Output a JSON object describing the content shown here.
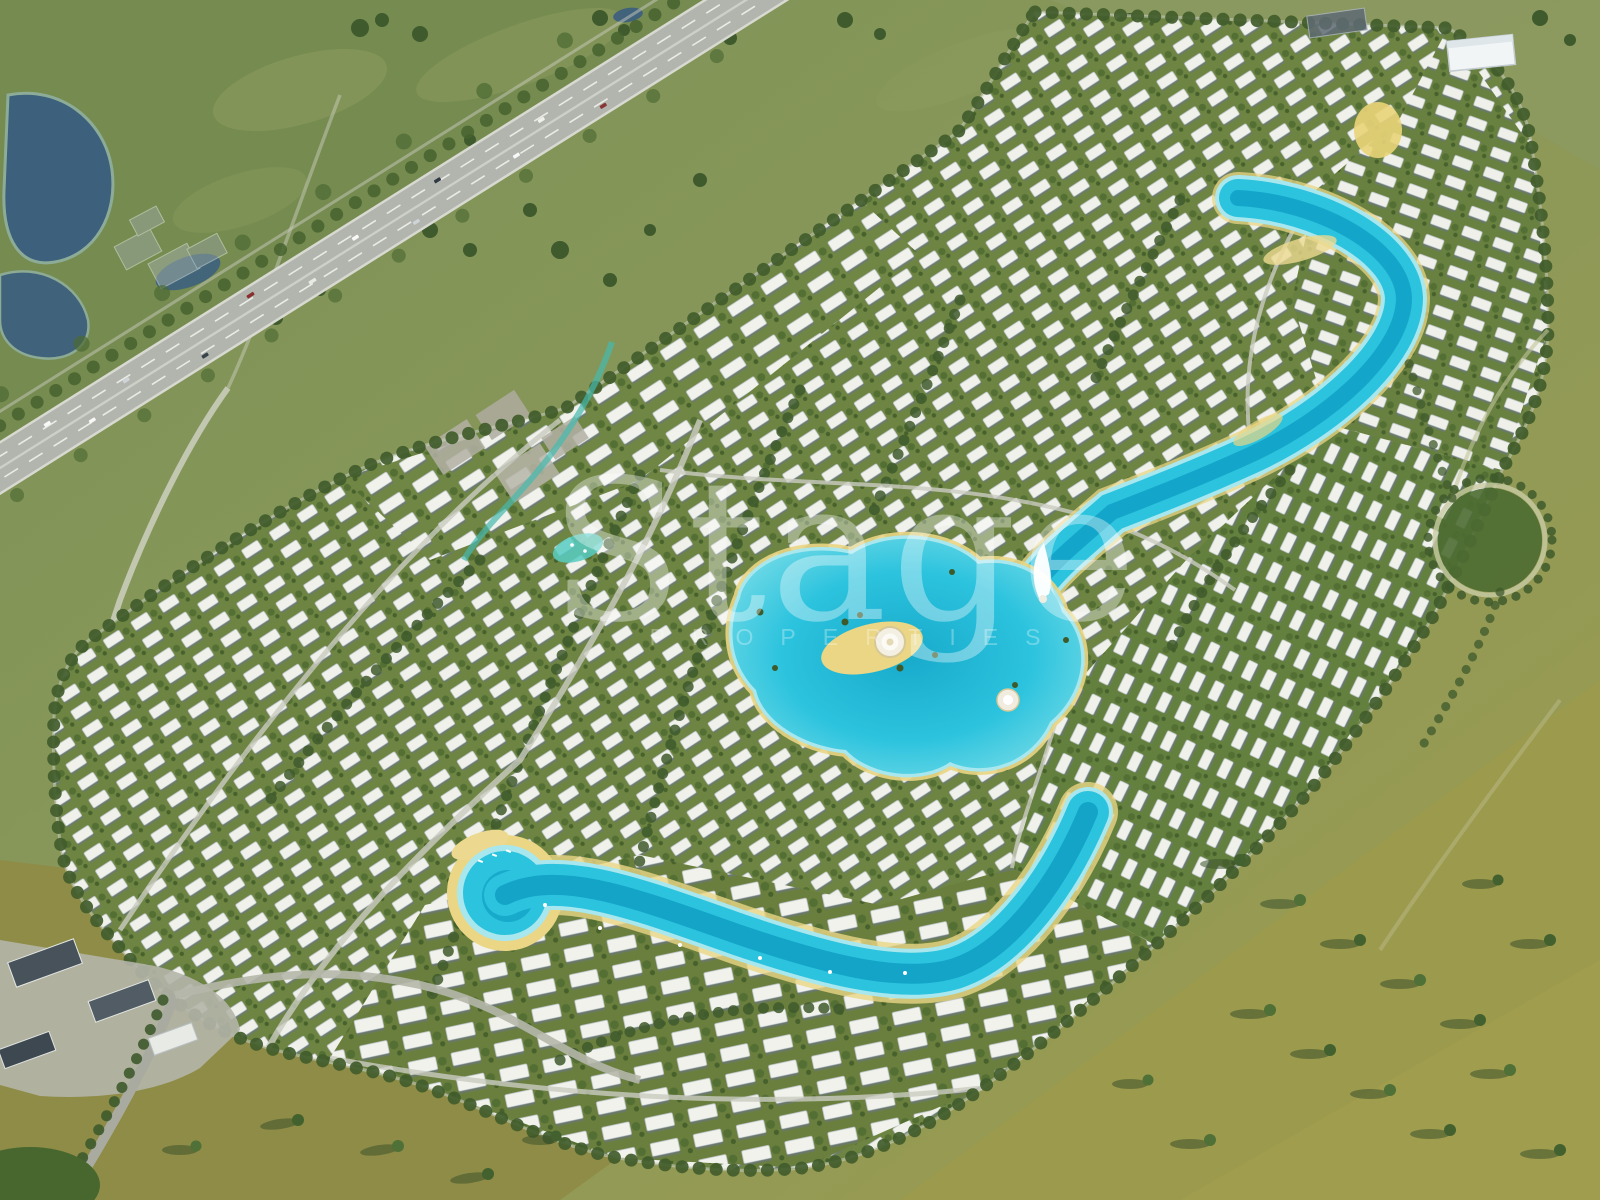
{
  "watermark": {
    "text": "Stage",
    "subtext": "PROPERTIES"
  },
  "scene": {
    "type": "aerial-masterplan-render",
    "setting": "aerial view of a large master-planned villa community with winding artificial turquoise lagoons, bounded by a highway and ponds to the north-west and open green-olive fields elsewhere",
    "landmarks": [
      "highway",
      "retention-ponds",
      "ghost-buildings",
      "north-lagoon",
      "central-lagoon",
      "dome-plaza",
      "sail-fountain",
      "south-lagoon",
      "beach-cove",
      "west-stream",
      "warehouse",
      "roundabout-park",
      "entrance-boulevard",
      "commercial-block",
      "villa-districts"
    ],
    "colors": {
      "field_green": "#87975a",
      "field_dark_green": "#74894f",
      "field_olive": "#99974b",
      "vegetation": "#6d8443",
      "tree": "#3f5a2c",
      "villa_roof": "#f0f1eb",
      "lagoon_water": "#2cc3de",
      "lagoon_deep": "#0f9fc4",
      "lagoon_shallow": "#a8e7ee",
      "sand": "#ead684",
      "asphalt": "#b1b5ad",
      "road_light": "#cdd0c4",
      "pond": "#3b5e80",
      "watermark": "#ffffff"
    }
  }
}
